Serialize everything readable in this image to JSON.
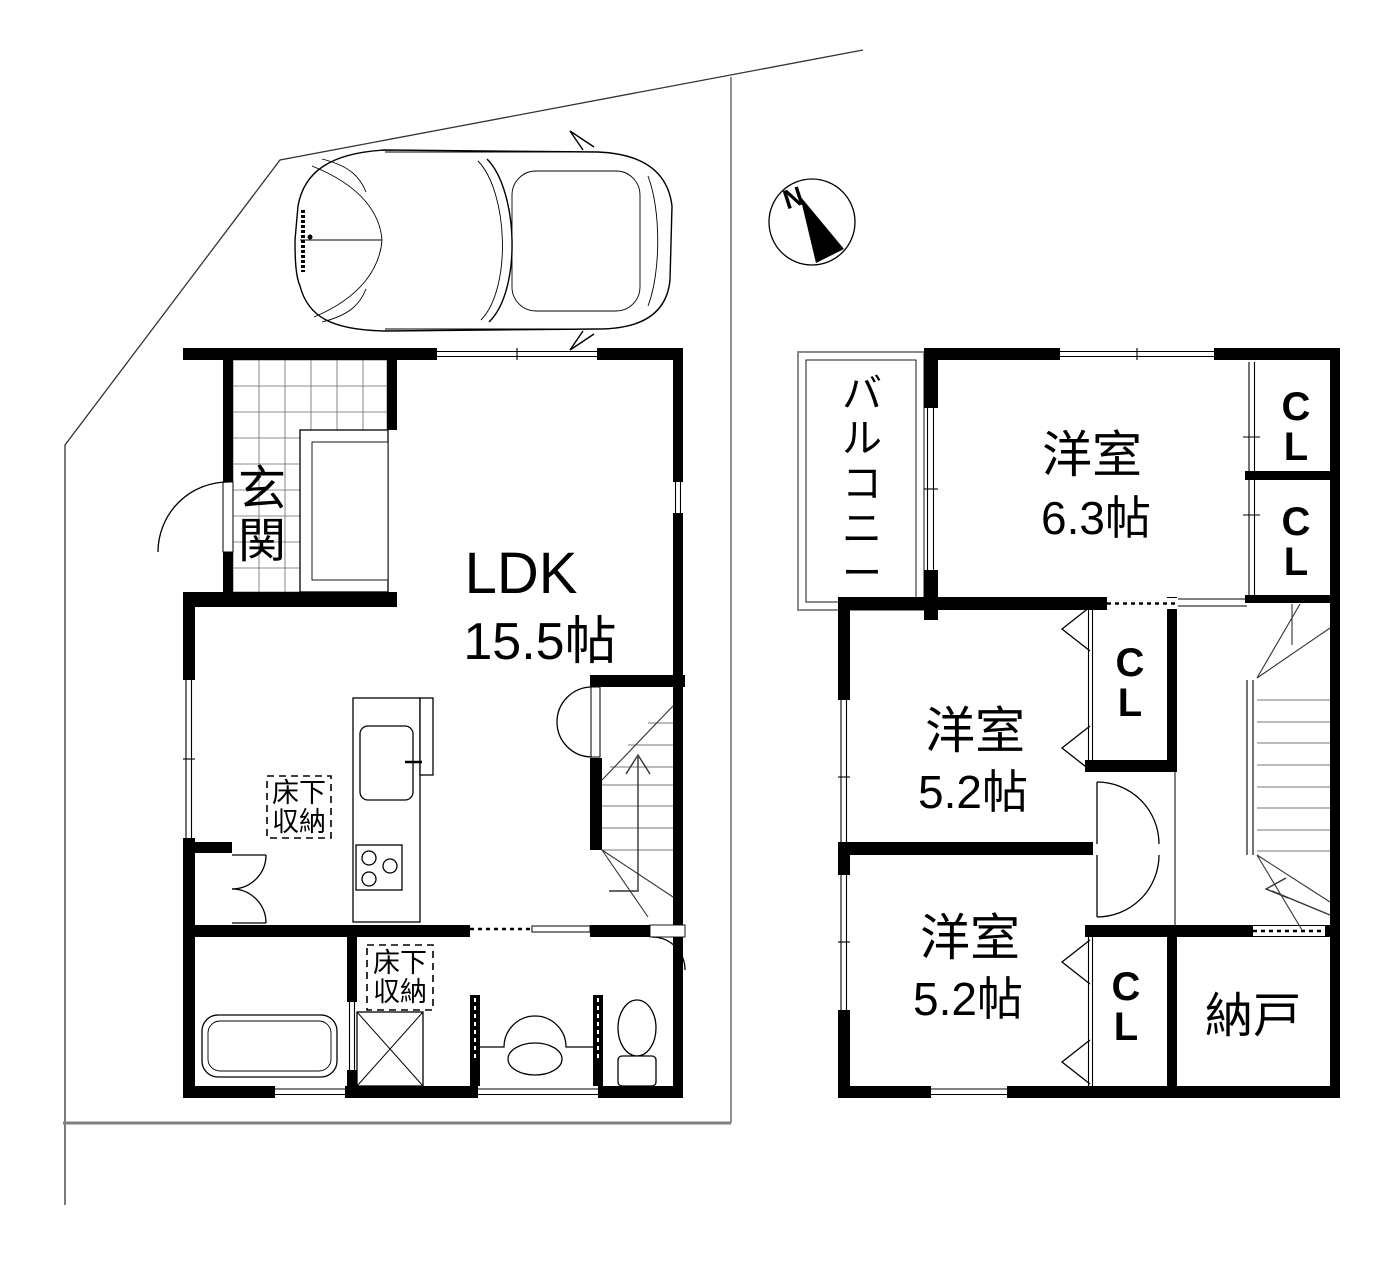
{
  "colors": {
    "ink": "#000000",
    "boundary_gray": "#808080",
    "tread_gray": "#777777"
  },
  "compass": {
    "north": "N"
  },
  "floor1": {
    "entrance_label": "玄関",
    "ldk_name": "LDK",
    "ldk_size": "15.5帖",
    "underfloor1_line1": "床下",
    "underfloor1_line2": "収納",
    "underfloor2_line1": "床下",
    "underfloor2_line2": "収納"
  },
  "floor2": {
    "balcony_label": "バルコニー",
    "room_a_name": "洋室",
    "room_a_size": "6.3帖",
    "room_b_name": "洋室",
    "room_b_size": "5.2帖",
    "room_c_name": "洋室",
    "room_c_size": "5.2帖",
    "closet1": "CL",
    "closet2": "CL",
    "closet3": "CL",
    "closet4": "CL",
    "storeroom_label": "納戸"
  }
}
